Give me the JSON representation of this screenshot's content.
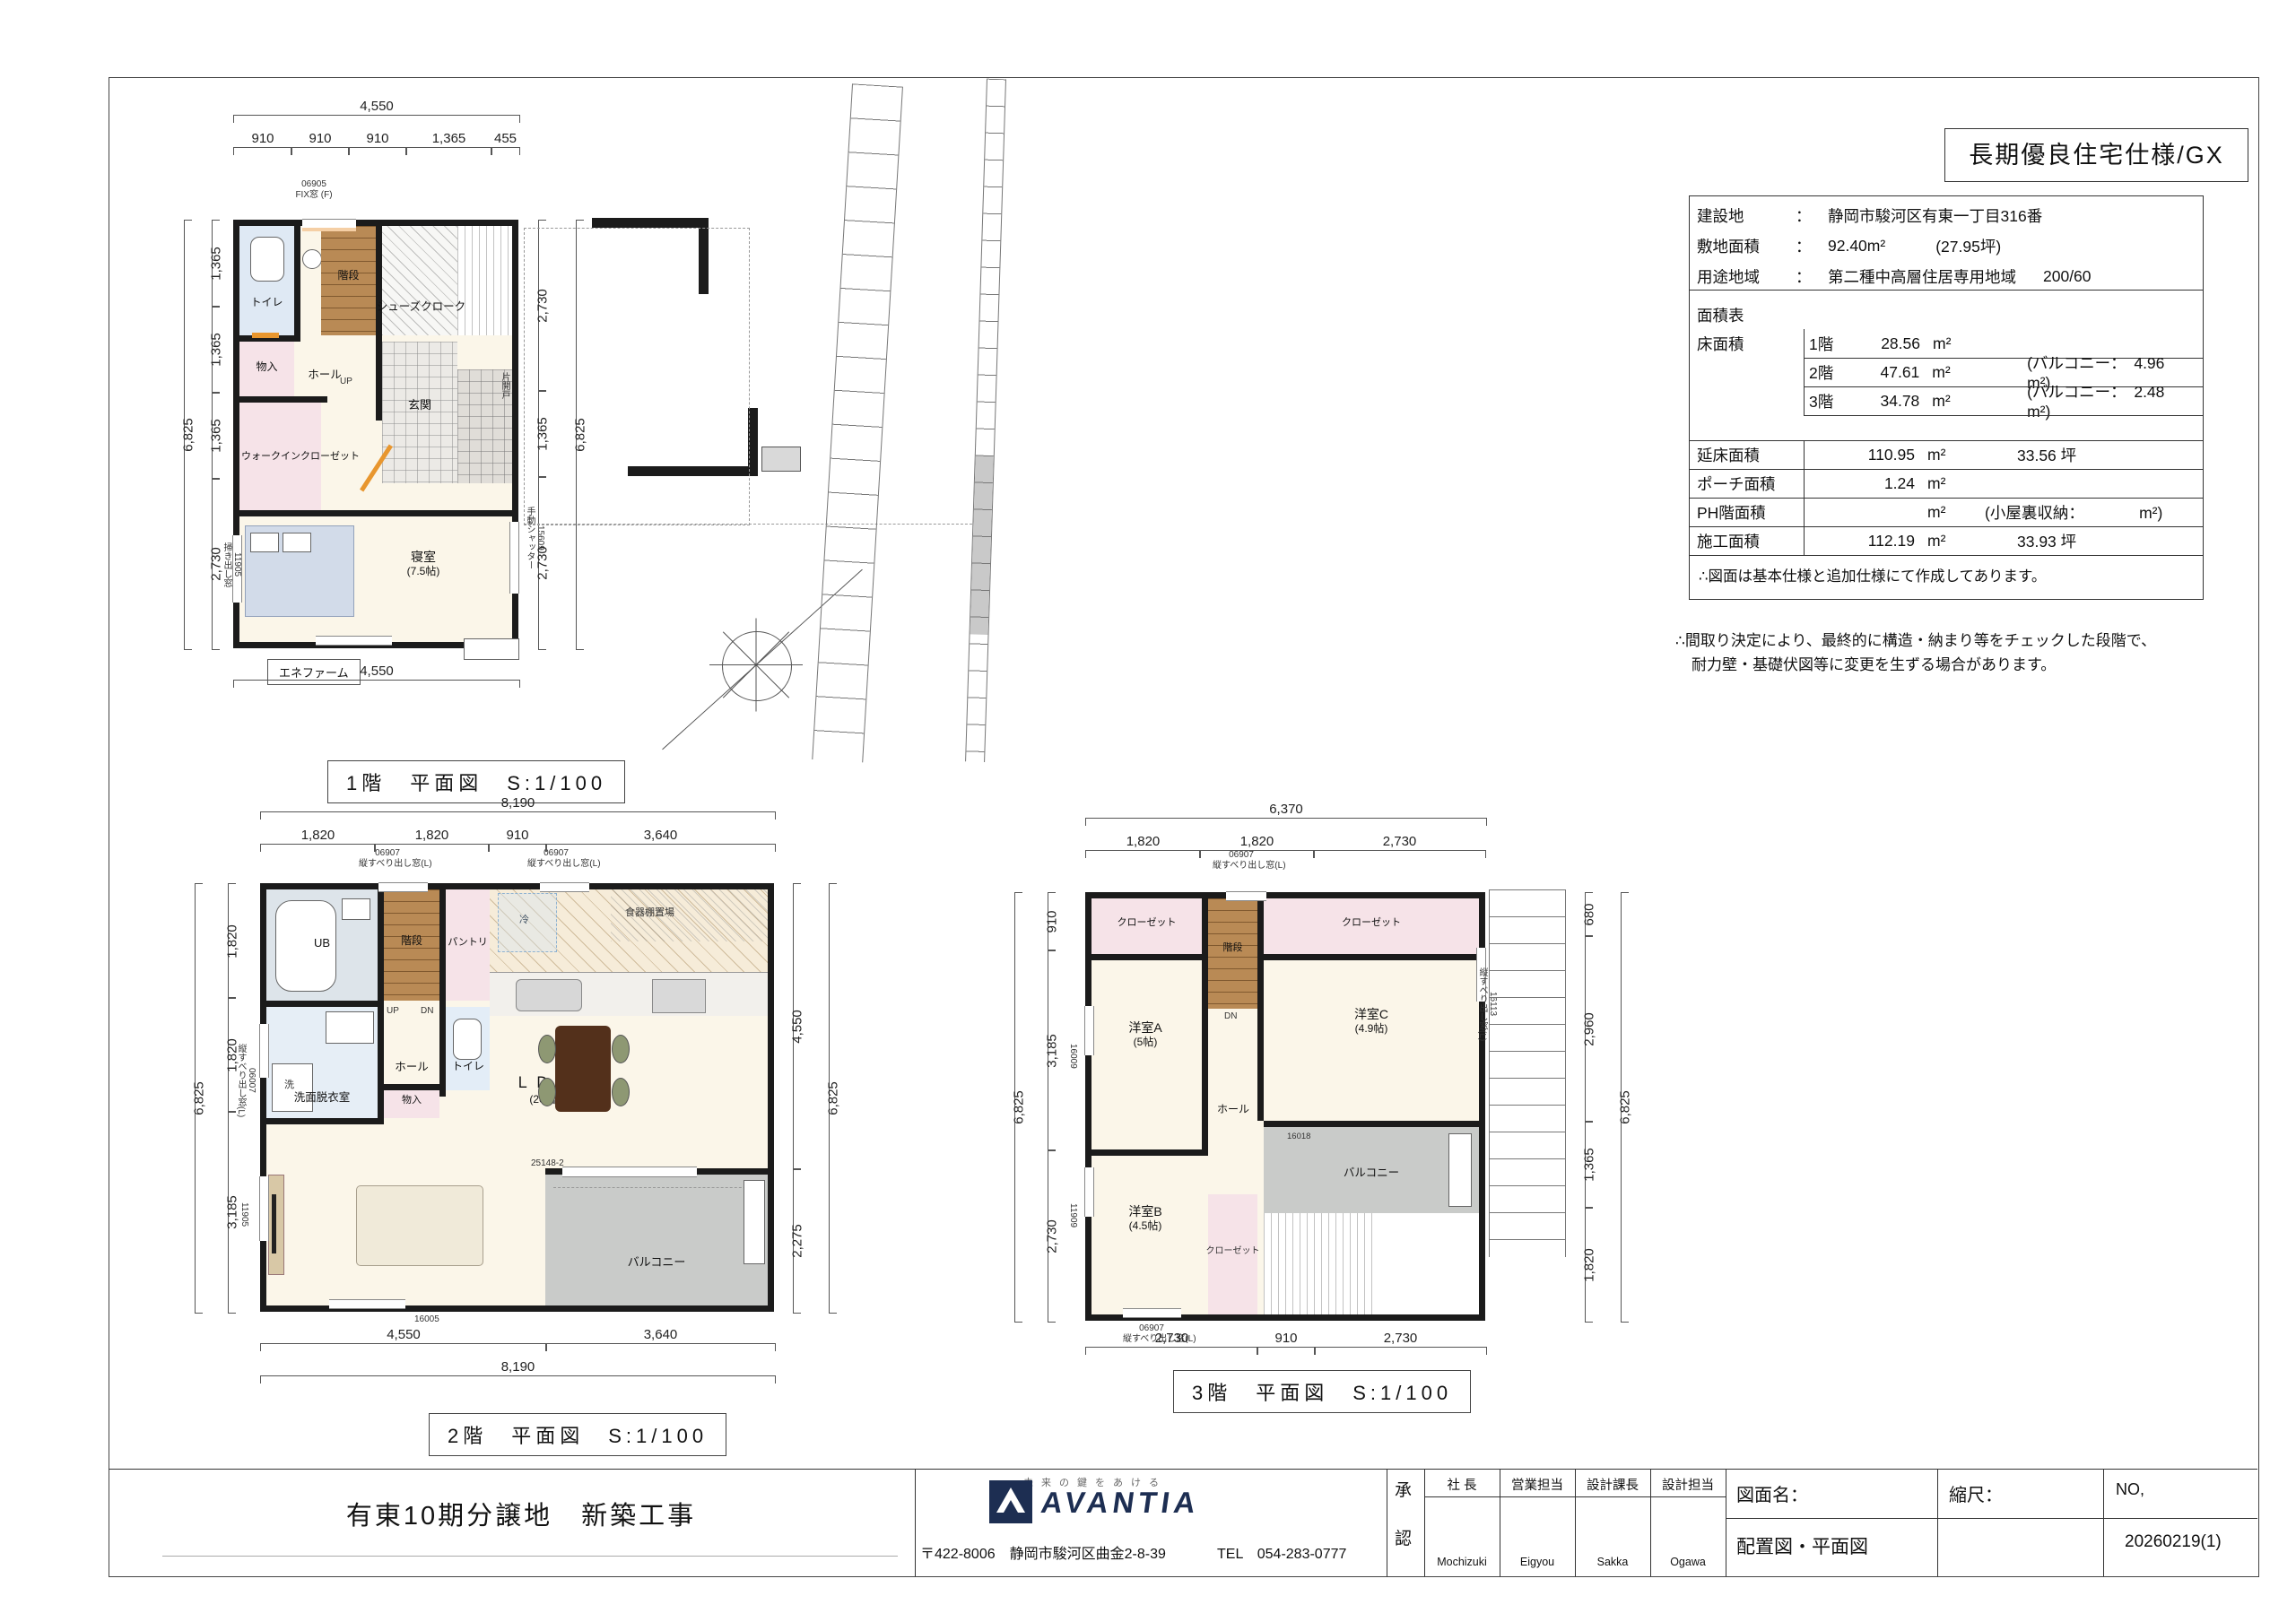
{
  "badge": "長期優良住宅仕様/GX",
  "site": {
    "rows": [
      {
        "k": "建設地",
        "c": "：",
        "v": "静岡市駿河区有東一丁目316番",
        "e": ""
      },
      {
        "k": "敷地面積",
        "c": "：",
        "v": "92.40m²",
        "e": "(27.95坪)"
      },
      {
        "k": "用途地域",
        "c": "：",
        "v": "第二種中高層住居専用地域",
        "e": "200/60"
      }
    ]
  },
  "area": {
    "title": "面積表",
    "floor_col": "床面積",
    "floors": [
      {
        "k": "1階",
        "v": "28.56",
        "u": "m²",
        "n": ""
      },
      {
        "k": "2階",
        "v": "47.61",
        "u": "m²",
        "n": "(バルコニー：　4.96　m²)"
      },
      {
        "k": "3階",
        "v": "34.78",
        "u": "m²",
        "n": "(バルコニー：　2.48　m²)"
      }
    ],
    "totals": [
      {
        "k": "延床面積",
        "v": "110.95",
        "u": "m²",
        "n": "33.56 坪"
      },
      {
        "k": "ポーチ面積",
        "v": "1.24",
        "u": "m²",
        "n": ""
      },
      {
        "k": "PH階面積",
        "v": "",
        "u": "m²",
        "n": "(小屋裏収納：　　　　m²)"
      },
      {
        "k": "施工面積",
        "v": "112.19",
        "u": "m²",
        "n": "33.93 坪"
      }
    ],
    "footnote": "∴図面は基本仕様と追加仕様にて作成してあります。"
  },
  "remark1": "∴間取り決定により、最終的に構造・納まり等をチェックした段階で、",
  "remark2": "耐力壁・基礎伏図等に変更を生ずる場合があります。",
  "f1": {
    "caption": "1階　平面図　S:1/100",
    "toilet": "トイレ",
    "stairs": "階段",
    "shoes": "シューズクローク",
    "storage": "物入",
    "hall": "ホール",
    "up": "UP",
    "entrance": "玄関",
    "wic": "ウォークインクローゼット",
    "bed": "寝室",
    "bed_size": "(7.5帖)",
    "enefarm": "エネファーム",
    "w_top": "06905",
    "w_top_sub": "FIX窓 (F)",
    "w_left": "11905",
    "w_left_sub": "掃き出し窓",
    "w_right": "15609",
    "w_right_sub": "手動シャッター",
    "door": "片開戸",
    "d_top_total": "4,550",
    "d_top": [
      "910",
      "910",
      "910",
      "1,365",
      "455"
    ],
    "d_left_total": "6,825",
    "d_left": [
      "1,365",
      "1,365",
      "1,365",
      "2,730"
    ],
    "d_right": [
      "2,730",
      "1,365",
      "2,730"
    ],
    "d_right_total": "6,825",
    "d_bottom": "4,550"
  },
  "f2": {
    "caption": "2階　平面図　S:1/100",
    "ub": "UB",
    "stairs": "階段",
    "pantry": "パントリ",
    "toilet": "トイレ",
    "hall": "ホール",
    "up": "UP",
    "dn": "DN",
    "wash": "洗面脱衣室",
    "laundry": "洗",
    "storage": "物入",
    "ldk": "ＬＤＫ",
    "ldk_size": "(20帖)",
    "balcony": "バルコニー",
    "cupboard": "食器棚置場",
    "fridge": "冷",
    "w1": "06907",
    "w1_sub": "縦すべり出し窓(L)",
    "w2": "06907",
    "w2_sub": "縦すべり出し窓(L)",
    "w_left": "06007",
    "w_left_sub": "縦すべり出し窓(L)",
    "w_left2": "11905",
    "w_bottom": "16005",
    "w_bal": "25148-2",
    "d_top_total": "8,190",
    "d_top": [
      "1,820",
      "1,820",
      "910",
      "3,640"
    ],
    "d_left": [
      "1,820",
      "1,820",
      "3,185"
    ],
    "d_left_total": "6,825",
    "d_right": [
      "4,550",
      "2,275"
    ],
    "d_right_total": "6,825",
    "d_bottom": [
      "4,550",
      "3,640"
    ],
    "d_bottom_total": "8,190"
  },
  "f3": {
    "caption": "3階　平面図　S:1/100",
    "closet": "クローゼット",
    "stairs": "階段",
    "dn": "DN",
    "hall": "ホール",
    "roomA": "洋室A",
    "roomA_size": "(5帖)",
    "roomB": "洋室B",
    "roomB_size": "(4.5帖)",
    "roomC": "洋室C",
    "roomC_size": "(4.9帖)",
    "balcony": "バルコニー",
    "w_top": "06907",
    "w_top_sub": "縦すべり出し窓(L)",
    "w_right": "16113",
    "w_right_sub": "縦すべり出し窓(L)",
    "w_l1": "16009",
    "w_l2": "11909",
    "w_bal": "16018",
    "w_bottom": "06907",
    "w_bottom_sub": "縦すべり出し窓(L)",
    "d_top_total": "6,370",
    "d_top": [
      "1,820",
      "1,820",
      "2,730"
    ],
    "d_left": [
      "910",
      "3,185",
      "2,730"
    ],
    "d_left_total": "6,825",
    "d_right": [
      "680",
      "2,960",
      "1,365",
      "1,820"
    ],
    "d_right_total": "6,825",
    "d_bottom": [
      "2,730",
      "910",
      "2,730"
    ]
  },
  "tb": {
    "project": "有東10期分譲地　新築工事",
    "tagline": "未来の鍵をあける",
    "logo": "AVANTIA",
    "address": "〒422-8006　静岡市駿河区曲金2-8-39",
    "tel": "TEL　054-283-0777",
    "ap1": "承",
    "ap2": "認",
    "roles": [
      "社 長",
      "営業担当",
      "設計課長",
      "設計担当"
    ],
    "names": [
      "Mochizuki",
      "Eigyou",
      "Sakka",
      "Ogawa"
    ],
    "sheet_k": "図面名：",
    "sheet_v": "配置図・平面図",
    "scale_k": "縮尺：",
    "no_k": "NO,",
    "no_v": "20260219(1)"
  }
}
